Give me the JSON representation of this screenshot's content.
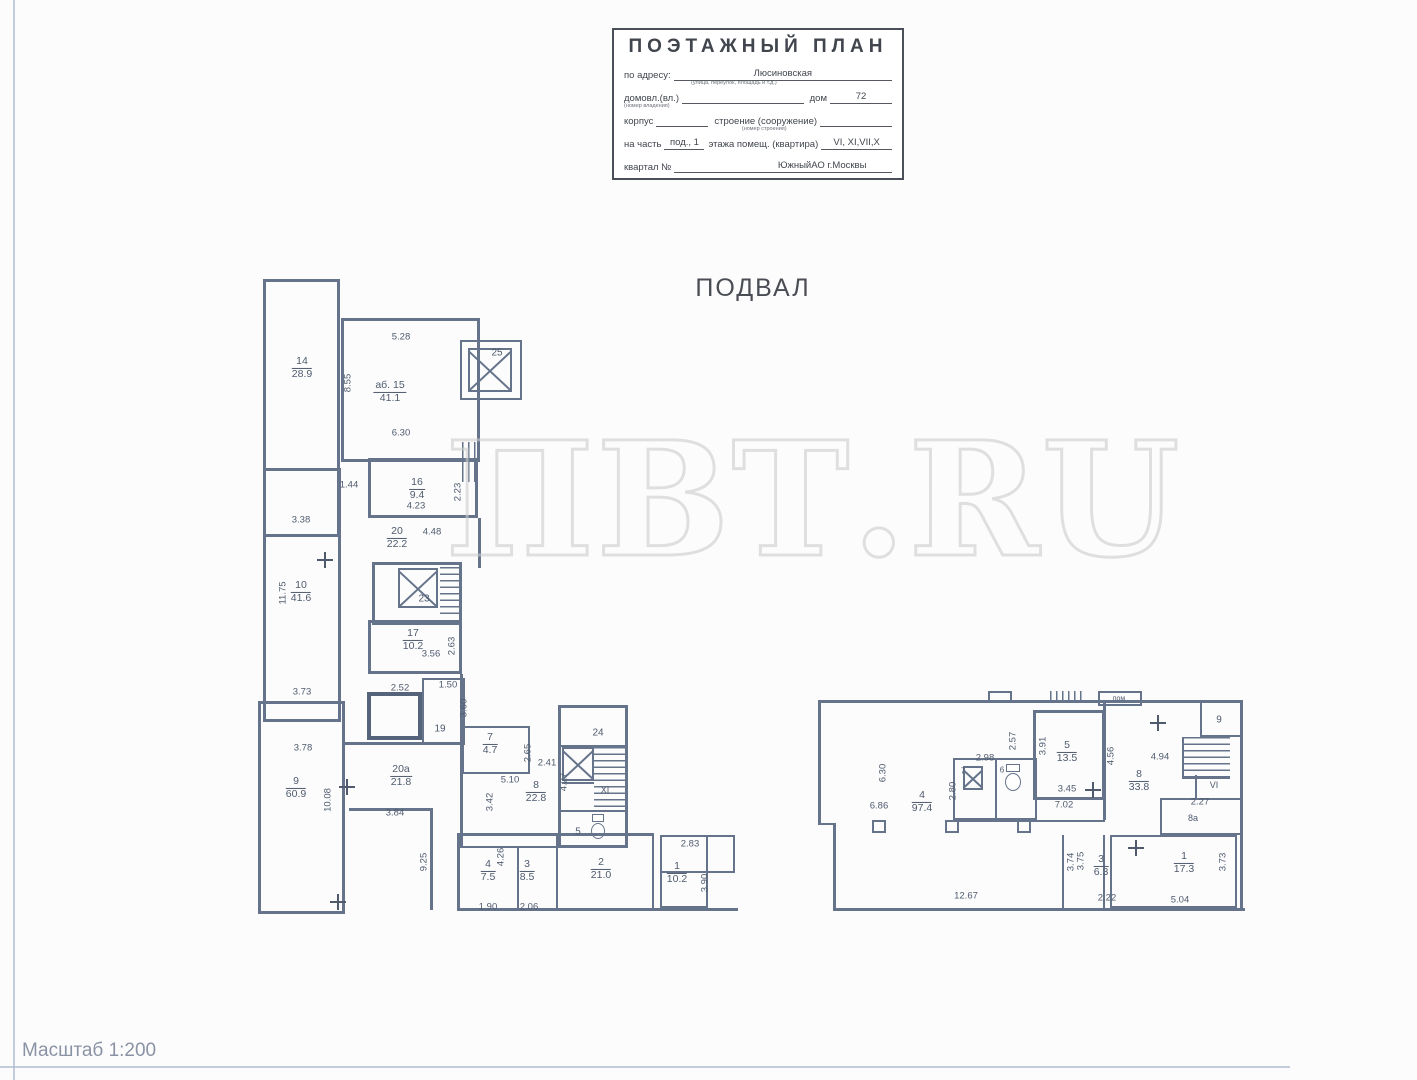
{
  "stamp": {
    "title": "ПОЭТАЖНЫЙ ПЛАН",
    "address_label": "по адресу:",
    "address_value": "Люсиновская",
    "address_caption": "(улица, переулок, площадь и т.д.)",
    "line2_label": "домовл.(вл.)",
    "line2_caption": "(номер владения)",
    "line2_mid": "дом",
    "line2_value": "72",
    "line3_label": "корпус",
    "line3_mid": "строение (сооружение)",
    "line3_caption": "(номер строения)",
    "line4_pre": "на часть",
    "line4_value1": "под., 1",
    "line4_mid": "этажа помещ. (квартира)",
    "line4_value2": "VI, XI,VII,X",
    "line5_label": "квартал №",
    "line5_value": "ЮжныйАО г.Москвы"
  },
  "plan_title": "ПОДВАЛ",
  "watermark": "ПВТ.RU",
  "scale_note": "Масштаб 1:200",
  "plan": {
    "room_labels": [
      {
        "x": 302,
        "y": 368,
        "num": "14",
        "area": "28.9"
      },
      {
        "x": 390,
        "y": 392,
        "num": "аб. 15",
        "area": "41.1"
      },
      {
        "x": 417,
        "y": 489,
        "num": "16",
        "area": "9.4"
      },
      {
        "x": 397,
        "y": 538,
        "num": "20",
        "area": "22.2"
      },
      {
        "x": 301,
        "y": 592,
        "num": "10",
        "area": "41.6"
      },
      {
        "x": 413,
        "y": 640,
        "num": "17",
        "area": "10.2"
      },
      {
        "x": 296,
        "y": 788,
        "num": "9",
        "area": "60.9"
      },
      {
        "x": 401,
        "y": 776,
        "num": "20а",
        "area": "21.8"
      },
      {
        "x": 490,
        "y": 744,
        "num": "7",
        "area": "4.7"
      },
      {
        "x": 536,
        "y": 792,
        "num": "8",
        "area": "22.8"
      },
      {
        "x": 488,
        "y": 871,
        "num": "4",
        "area": "7.5"
      },
      {
        "x": 527,
        "y": 871,
        "num": "3",
        "area": "8.5"
      },
      {
        "x": 601,
        "y": 869,
        "num": "2",
        "area": "21.0"
      },
      {
        "x": 677,
        "y": 873,
        "num": "1",
        "area": "10.2"
      },
      {
        "x": 922,
        "y": 802,
        "num": "4",
        "area": "97.4"
      },
      {
        "x": 1067,
        "y": 752,
        "num": "5",
        "area": "13.5"
      },
      {
        "x": 1139,
        "y": 781,
        "num": "8",
        "area": "33.8"
      },
      {
        "x": 1101,
        "y": 866,
        "num": "3",
        "area": "6.3"
      },
      {
        "x": 1184,
        "y": 863,
        "num": "1",
        "area": "17.3"
      }
    ],
    "dim_labels": [
      {
        "x": 401,
        "y": 337,
        "t": "5.28",
        "v": false
      },
      {
        "x": 348,
        "y": 383,
        "t": "8.55",
        "v": true
      },
      {
        "x": 301,
        "y": 520,
        "t": "3.38",
        "v": false
      },
      {
        "x": 401,
        "y": 433,
        "t": "6.30",
        "v": false
      },
      {
        "x": 349,
        "y": 485,
        "t": "1.44",
        "v": false
      },
      {
        "x": 458,
        "y": 492,
        "t": "2.23",
        "v": true
      },
      {
        "x": 416,
        "y": 506,
        "t": "4.23",
        "v": false
      },
      {
        "x": 432,
        "y": 532,
        "t": "4.48",
        "v": false
      },
      {
        "x": 283,
        "y": 593,
        "t": "11.75",
        "v": true
      },
      {
        "x": 302,
        "y": 692,
        "t": "3.73",
        "v": false
      },
      {
        "x": 452,
        "y": 646,
        "t": "2.63",
        "v": true
      },
      {
        "x": 431,
        "y": 654,
        "t": "3.56",
        "v": false
      },
      {
        "x": 400,
        "y": 688,
        "t": "2.52",
        "v": false
      },
      {
        "x": 448,
        "y": 685,
        "t": "1.50",
        "v": false
      },
      {
        "x": 464,
        "y": 708,
        "t": "3.60",
        "v": true
      },
      {
        "x": 303,
        "y": 748,
        "t": "3.78",
        "v": false
      },
      {
        "x": 328,
        "y": 800,
        "t": "10.08",
        "v": true
      },
      {
        "x": 395,
        "y": 813,
        "t": "3.84",
        "v": false
      },
      {
        "x": 424,
        "y": 862,
        "t": "9.25",
        "v": true
      },
      {
        "x": 528,
        "y": 753,
        "t": "2.65",
        "v": true
      },
      {
        "x": 547,
        "y": 763,
        "t": "2.41",
        "v": false
      },
      {
        "x": 510,
        "y": 780,
        "t": "5.10",
        "v": false
      },
      {
        "x": 490,
        "y": 802,
        "t": "3.42",
        "v": true
      },
      {
        "x": 564,
        "y": 782,
        "t": "4.27",
        "v": true
      },
      {
        "x": 501,
        "y": 857,
        "t": "4.26",
        "v": true
      },
      {
        "x": 488,
        "y": 907,
        "t": "1.90",
        "v": false
      },
      {
        "x": 529,
        "y": 907,
        "t": "2.06",
        "v": false
      },
      {
        "x": 690,
        "y": 844,
        "t": "2.83",
        "v": false
      },
      {
        "x": 705,
        "y": 883,
        "t": "3.90",
        "v": true
      },
      {
        "x": 883,
        "y": 773,
        "t": "6.30",
        "v": true
      },
      {
        "x": 879,
        "y": 806,
        "t": "6.86",
        "v": false
      },
      {
        "x": 985,
        "y": 758,
        "t": "2.98",
        "v": false
      },
      {
        "x": 953,
        "y": 791,
        "t": "2.80",
        "v": true
      },
      {
        "x": 1013,
        "y": 741,
        "t": "2.57",
        "v": true
      },
      {
        "x": 1043,
        "y": 746,
        "t": "3.91",
        "v": true
      },
      {
        "x": 1067,
        "y": 789,
        "t": "3.45",
        "v": false
      },
      {
        "x": 1064,
        "y": 805,
        "t": "7.02",
        "v": false
      },
      {
        "x": 1111,
        "y": 756,
        "t": "4.56",
        "v": true
      },
      {
        "x": 1160,
        "y": 757,
        "t": "4.94",
        "v": false
      },
      {
        "x": 1200,
        "y": 802,
        "t": "2.27",
        "v": false
      },
      {
        "x": 1071,
        "y": 862,
        "t": "3.74",
        "v": true
      },
      {
        "x": 1081,
        "y": 861,
        "t": "3.75",
        "v": true
      },
      {
        "x": 1107,
        "y": 898,
        "t": "2.22",
        "v": false
      },
      {
        "x": 1180,
        "y": 900,
        "t": "5.04",
        "v": false
      },
      {
        "x": 1223,
        "y": 862,
        "t": "3.73",
        "v": true
      },
      {
        "x": 966,
        "y": 896,
        "t": "12.67",
        "v": false
      }
    ],
    "text_labels": [
      {
        "x": 497,
        "y": 353,
        "t": "25",
        "s": 10
      },
      {
        "x": 424,
        "y": 599,
        "t": "23",
        "s": 10
      },
      {
        "x": 440,
        "y": 729,
        "t": "19",
        "s": 10
      },
      {
        "x": 598,
        "y": 733,
        "t": "24",
        "s": 10
      },
      {
        "x": 605,
        "y": 790,
        "t": "XI",
        "s": 9
      },
      {
        "x": 578,
        "y": 832,
        "t": "5",
        "s": 10
      },
      {
        "x": 1214,
        "y": 785,
        "t": "VI",
        "s": 9
      },
      {
        "x": 1193,
        "y": 818,
        "t": "8а",
        "s": 9
      },
      {
        "x": 1119,
        "y": 699,
        "t": "пом",
        "s": 7
      },
      {
        "x": 1219,
        "y": 720,
        "t": "9",
        "s": 10
      },
      {
        "x": 963,
        "y": 771,
        "t": "7",
        "s": 8
      },
      {
        "x": 1002,
        "y": 770,
        "t": "6",
        "s": 8
      }
    ]
  }
}
